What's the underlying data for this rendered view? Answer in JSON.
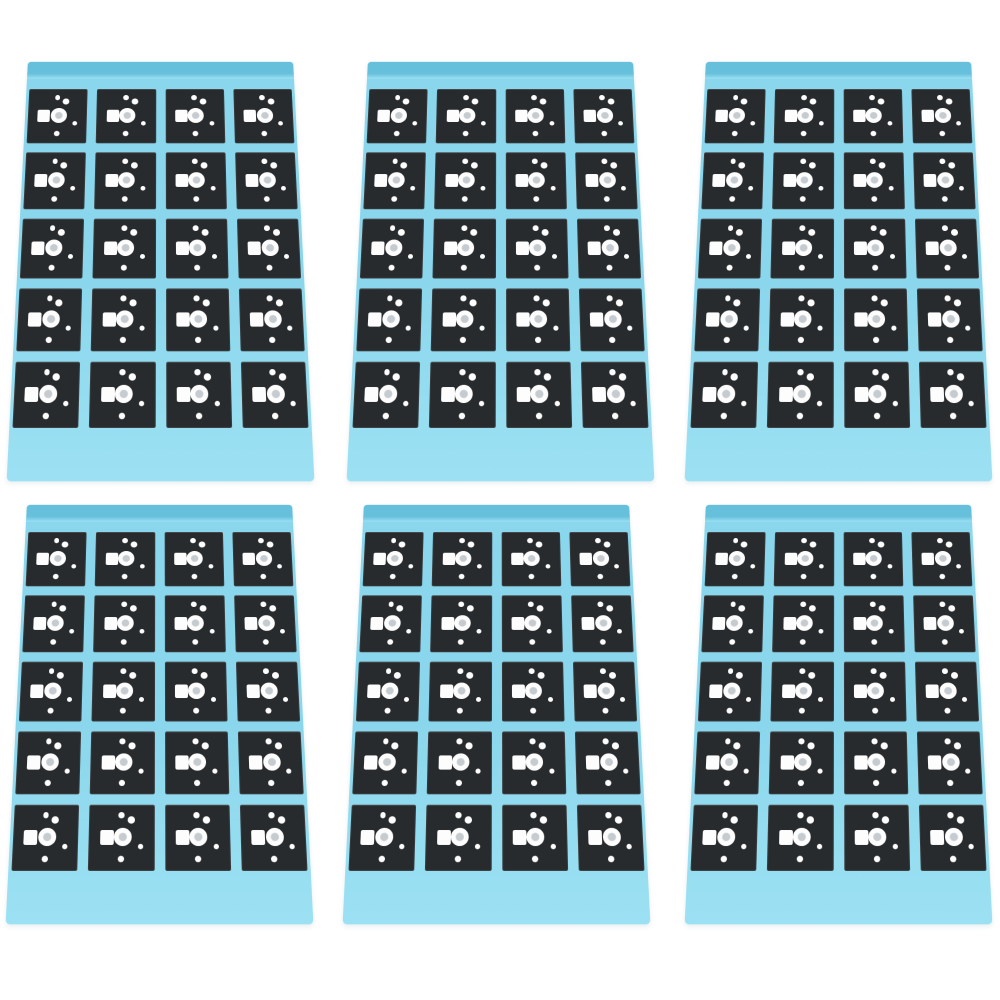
{
  "scene": {
    "description": "Product photo: six light-blue adhesive liner sheets, each holding a 4x5 grid of black die-cut adhesive pads with white cutouts (square, ring circle and four small dots per pad)",
    "background_color": "#ffffff",
    "sheets": {
      "count": 6,
      "arrangement_columns": 3,
      "arrangement_rows": 2,
      "body_color": "#8ad6ec",
      "body_color_light": "#9ce1f3",
      "top_strip_color": "#66c0dc",
      "pads_per_sheet": 20,
      "pad_grid_columns": 4,
      "pad_grid_rows": 5,
      "centers": [
        {
          "cx": 160,
          "cy": 256
        },
        {
          "cx": 500,
          "cy": 256
        },
        {
          "cx": 838,
          "cy": 256
        },
        {
          "cx": 159,
          "cy": 699
        },
        {
          "cx": 496,
          "cy": 699
        },
        {
          "cx": 838,
          "cy": 699
        }
      ]
    },
    "pad": {
      "color": "#282b2d",
      "cutout_color": "#fdfdfd",
      "ring_center_color": "#c5cbcf",
      "cutouts": [
        {
          "name": "small-dot-top-left-cutout",
          "shape": "circle",
          "x": 44.5,
          "y": 11.5,
          "w": 9,
          "h": 9
        },
        {
          "name": "dot-top-right-cutout",
          "shape": "circle",
          "x": 58.5,
          "y": 17.5,
          "w": 11,
          "h": 11
        },
        {
          "name": "square-cutout",
          "shape": "square",
          "x": 16.5,
          "y": 39.5,
          "w": 21,
          "h": 21
        },
        {
          "name": "ring-circle-cutout",
          "shape": "ring",
          "x": 38.5,
          "y": 35.5,
          "w": 27,
          "h": 27
        },
        {
          "name": "small-dot-right-cutout",
          "shape": "circle",
          "x": 75,
          "y": 60,
          "w": 8,
          "h": 8
        },
        {
          "name": "dot-bottom-cutout",
          "shape": "circle",
          "x": 45,
          "y": 77,
          "w": 10,
          "h": 10
        }
      ]
    }
  }
}
